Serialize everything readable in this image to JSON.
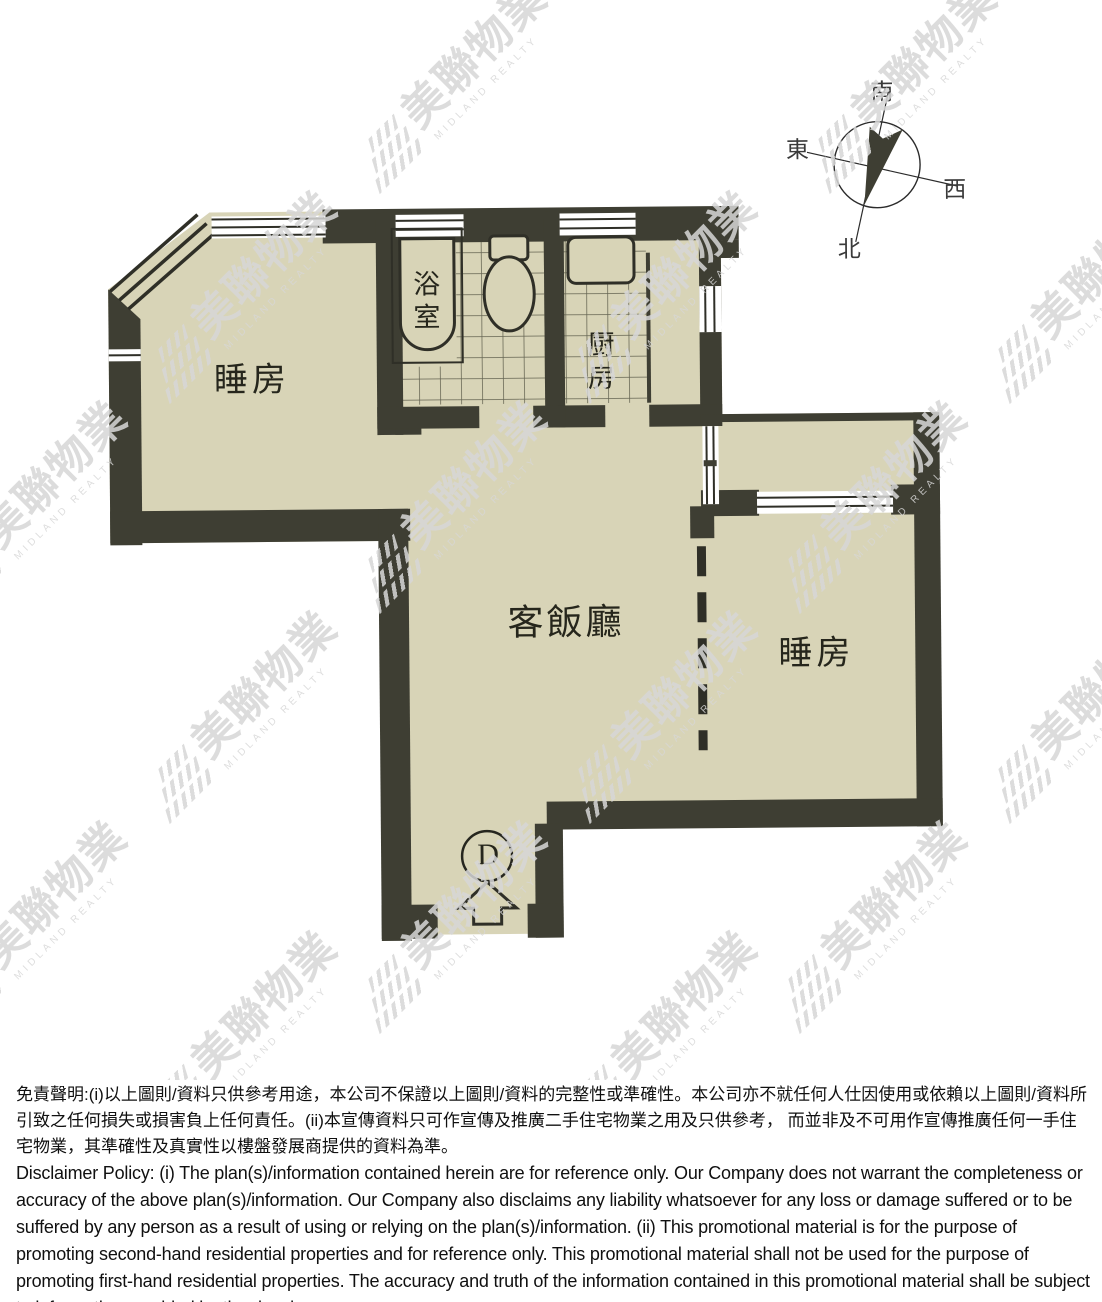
{
  "floor_plan": {
    "labels": {
      "bedroom_left": "睡房",
      "bathroom": "浴室",
      "kitchen": "厨房",
      "living_dining": "客飯廳",
      "bedroom_right": "睡房",
      "unit": "D"
    },
    "fixtures": [
      "bathtub",
      "toilet",
      "kitchen-sink",
      "entrance-arrow",
      "sliding-partition-dashed"
    ],
    "colors": {
      "wall": "#3e3e33",
      "floor": "#d8d4b7",
      "line": "#2f2f27",
      "tile_line": "#50503f"
    }
  },
  "compass": {
    "south": "南",
    "east": "東",
    "west": "西",
    "north": "北"
  },
  "watermark": {
    "name_cn": "美聯物業",
    "name_en": "MIDLAND REALTY",
    "color": "#d7d7d7"
  },
  "disclaimer": {
    "chinese": "免責聲明:(i)以上圖則/資料只供參考用途，本公司不保證以上圖則/資料的完整性或準確性。本公司亦不就任何人仕因使用或依賴以上圖則/資料所引致之任何損失或損害負上任何責任。(ii)本宣傳資料只可作宣傳及推廣二手住宅物業之用及只供參考， 而並非及不可用作宣傳推廣任何一手住宅物業，其準確性及真實性以樓盤發展商提供的資料為準。",
    "english": "Disclaimer Policy: (i) The plan(s)/information contained herein are for reference only. Our Company does not warrant the completeness or accuracy of the above plan(s)/information. Our Company also disclaims any liability whatsoever for any loss or damage suffered or to be suffered by any person as a result of using or relying on the plan(s)/information. (ii) This promotional material is for the purpose of promoting second-hand residential properties and for reference only. This promotional material shall not be used for the purpose of promoting first-hand residential properties. The accuracy and truth of the information contained in this promotional material shall be subject to information provided by the developers."
  }
}
